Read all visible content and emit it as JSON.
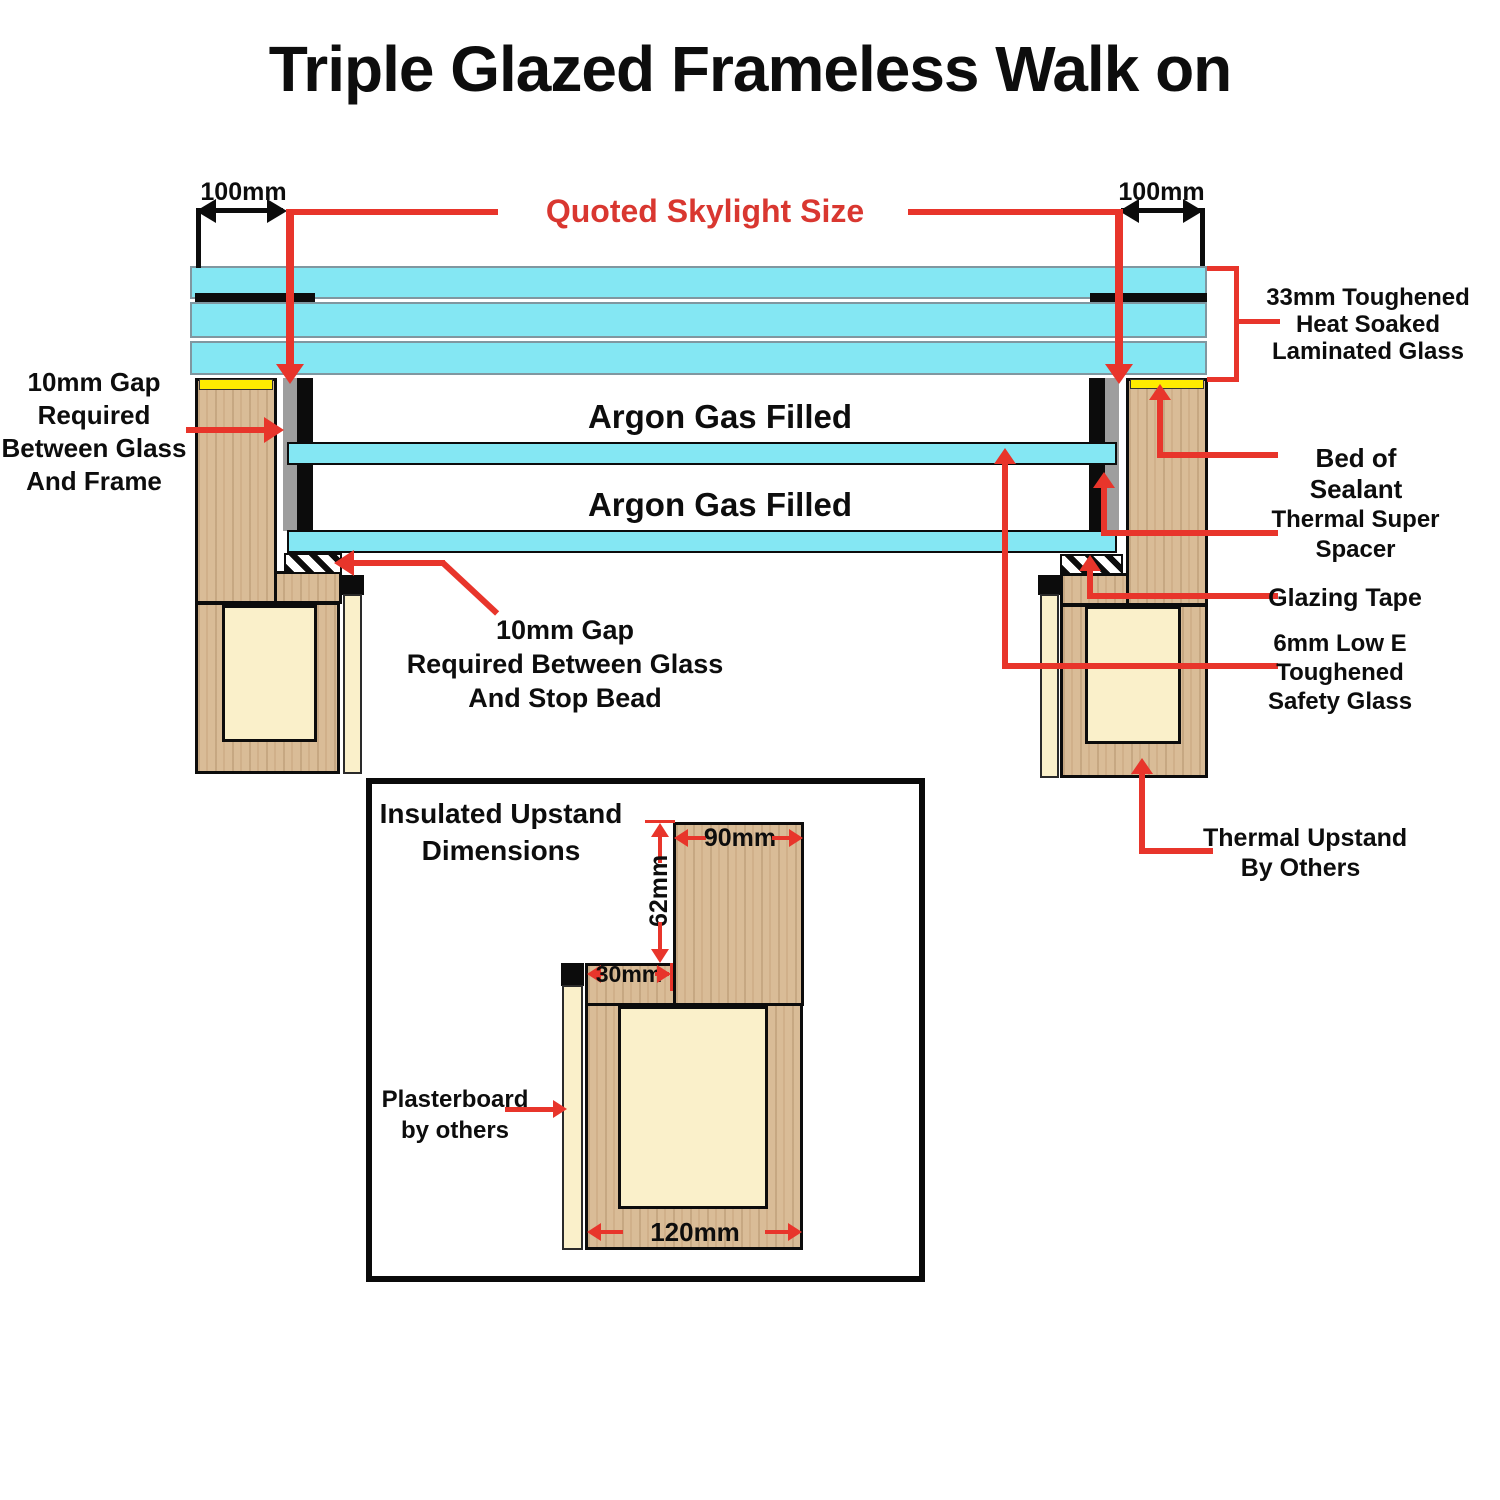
{
  "title": "Triple Glazed Frameless Walk on",
  "dims": {
    "left": "100mm",
    "right": "100mm",
    "quoted": "Quoted Skylight Size"
  },
  "glass": {
    "argon_top": "Argon Gas Filled",
    "argon_bottom": "Argon Gas Filled"
  },
  "labels": {
    "gap_frame": {
      "l1": "10mm Gap",
      "l2": "Required",
      "l3": "Between Glass",
      "l4": "And Frame"
    },
    "laminated": {
      "l1": "33mm Toughened",
      "l2": "Heat Soaked",
      "l3": "Laminated Glass"
    },
    "sealant": "Bed of Sealant",
    "spacer": {
      "l1": "Thermal Super",
      "l2": "Spacer"
    },
    "glazing_tape": "Glazing Tape",
    "low_e": {
      "l1": "6mm Low E",
      "l2": "Toughened",
      "l3": "Safety Glass"
    },
    "thermal_upstand": {
      "l1": "Thermal Upstand",
      "l2": "By Others"
    },
    "gap_bead": {
      "l1": "10mm Gap",
      "l2": "Required Between Glass",
      "l3": "And Stop Bead"
    }
  },
  "inset": {
    "title": {
      "l1": "Insulated Upstand",
      "l2": "Dimensions"
    },
    "dim_top": "90mm",
    "dim_height": "62mm",
    "dim_step": "30mm",
    "dim_base": "120mm",
    "plasterboard": {
      "l1": "Plasterboard",
      "l2": "by others"
    }
  },
  "colors": {
    "glass_cyan": "#84e7f3",
    "annotation_red": "#e8352b",
    "wood_tan": "#d9bc97",
    "insulation_cream": "#faf0ca",
    "sealant_yellow": "#ffec00",
    "spacer_gray": "#9e9e9e"
  }
}
